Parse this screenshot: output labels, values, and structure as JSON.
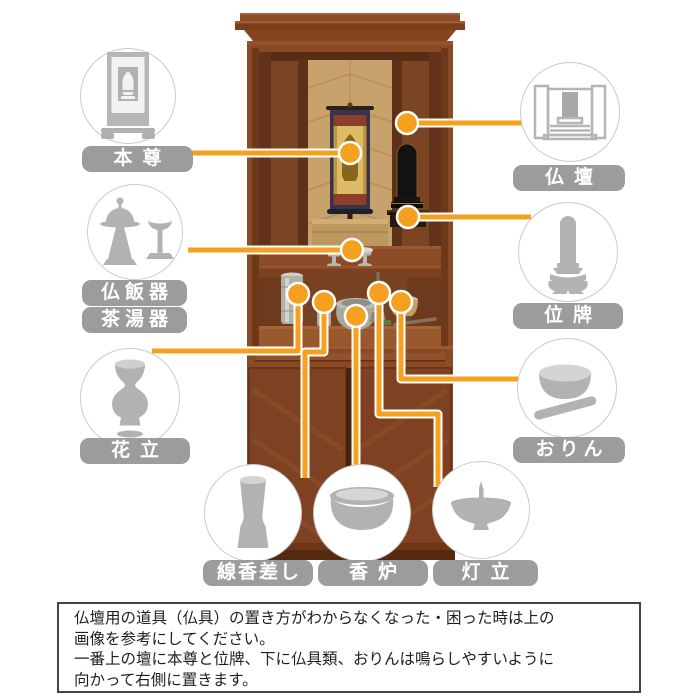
{
  "colors": {
    "accent_orange": "#F5A01E",
    "label_gray": "#9C9C9C",
    "icon_gray": "#B2B2B2",
    "circle_border": "#CBCBCB",
    "note_border": "#444444",
    "background": "#FFFFFF"
  },
  "callouts": {
    "honzon": {
      "label": "本尊"
    },
    "butsudan": {
      "label": "仏壇"
    },
    "butsuhanki": {
      "label": "仏飯器"
    },
    "chatouki": {
      "label": "茶湯器"
    },
    "ihai": {
      "label": "位牌"
    },
    "hanatate": {
      "label": "花立"
    },
    "orin": {
      "label": "おりん"
    },
    "senkousashi": {
      "label": "線香差し"
    },
    "kouro": {
      "label": "香炉"
    },
    "tohtate": {
      "label": "灯立"
    }
  },
  "note": {
    "line1": "仏壇用の道具（仏具）の置き方がわからなくなった・困った時は上の",
    "line2": "画像を参考にしてください。",
    "line3": "一番上の壇に本尊と位牌、下に仏具類、おりんは鳴らしやすいように",
    "line4": "向かって右側に置きます。"
  }
}
